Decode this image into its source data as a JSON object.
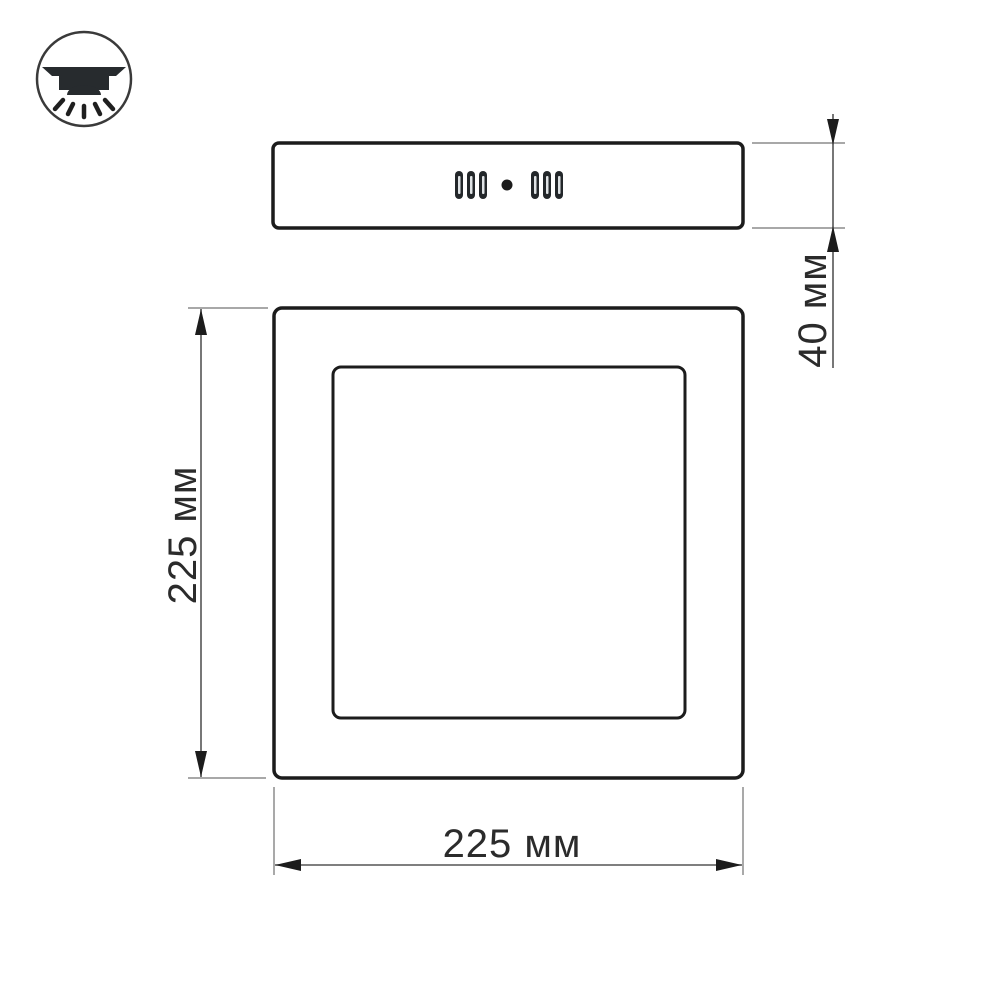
{
  "image": {
    "type": "technical-dimension-drawing",
    "subject": "square surface-mounted LED panel light",
    "background": "#ffffff"
  },
  "icon": {
    "name": "surface-mount-downlight-icon"
  },
  "views": {
    "side_view": {
      "vent_slots_left": 3,
      "vent_slots_right": 3,
      "center_dot": true
    },
    "front_view": {
      "outer_frame": "square",
      "inner_diffuser": "square"
    }
  },
  "dimensions": {
    "panel_thickness": "40 мм",
    "panel_height": "225 мм",
    "panel_width": "225 мм"
  },
  "colors": {
    "object_line": "#1c1c1c",
    "dimension_line": "#555555",
    "extension_line": "#8c8c8c",
    "label_text": "#2b2b2b"
  }
}
